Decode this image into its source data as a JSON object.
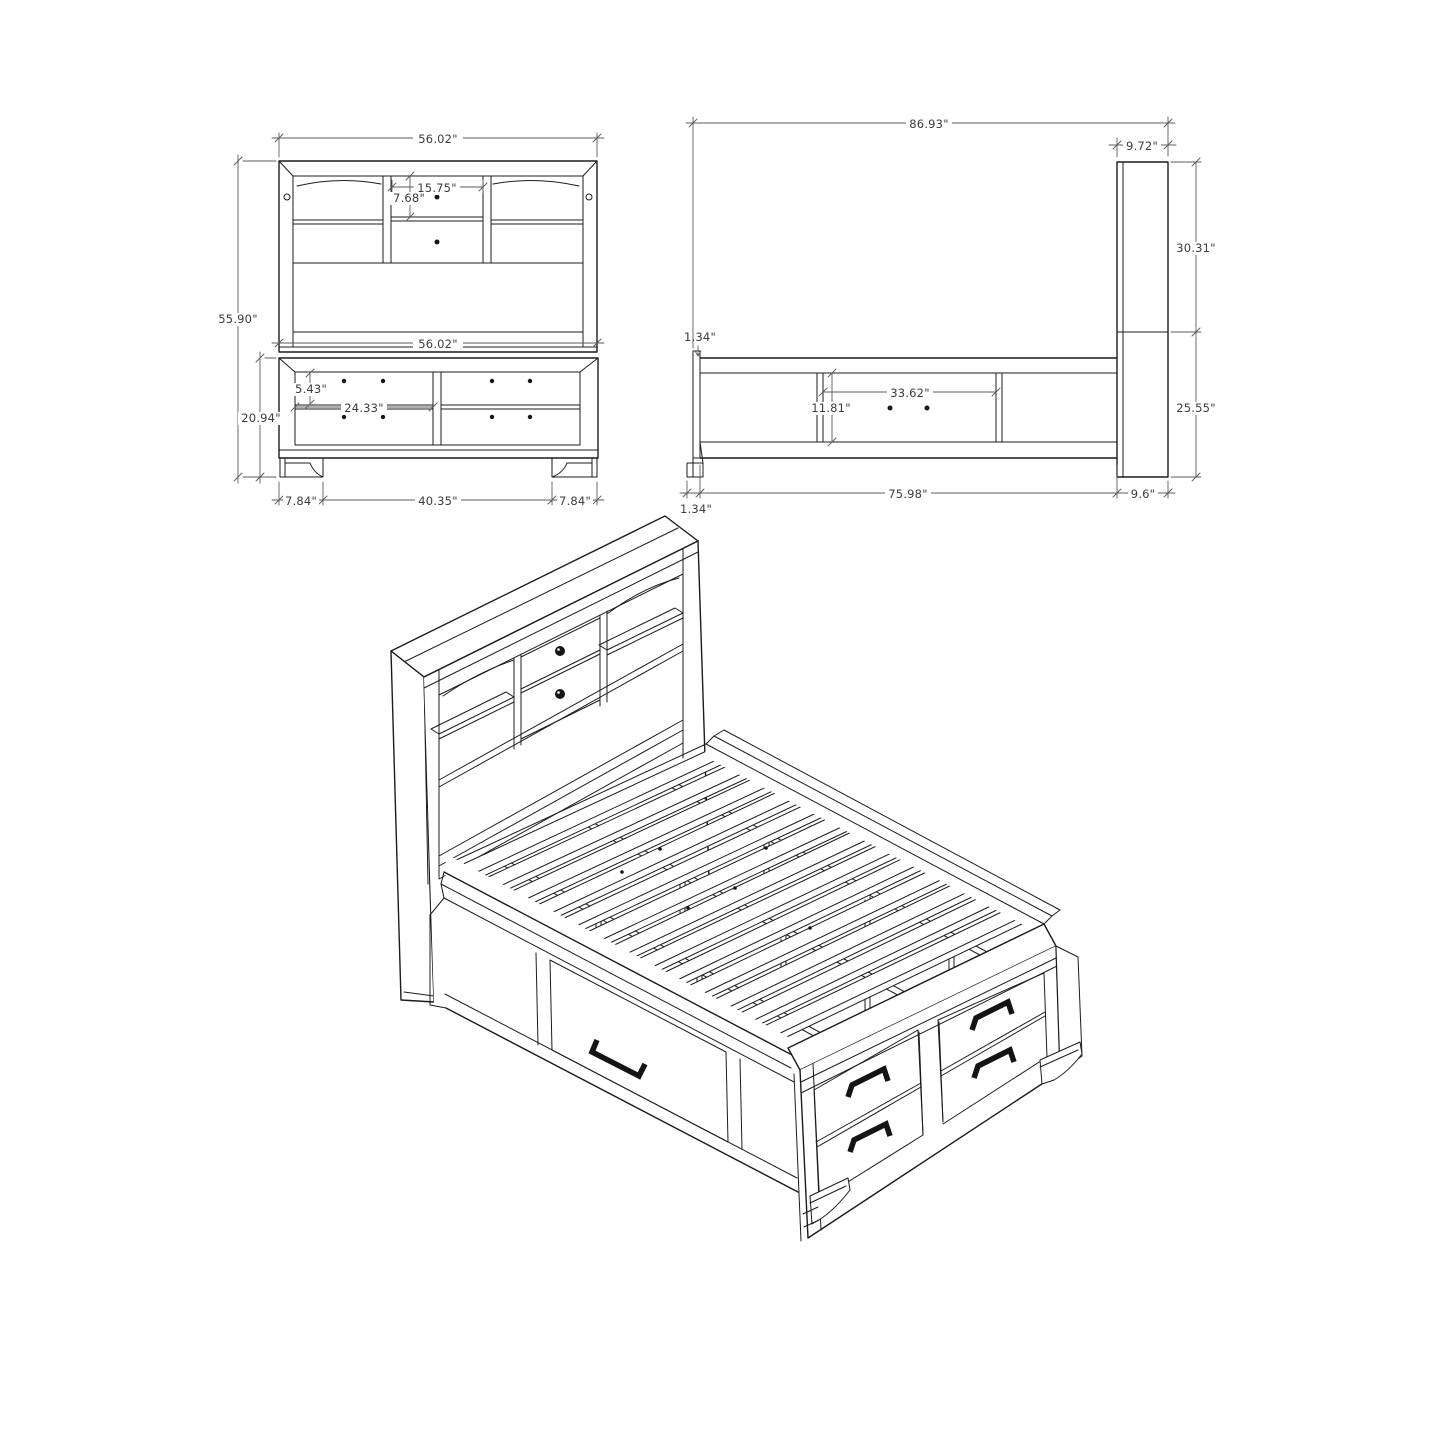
{
  "document": {
    "type": "furniture-dimension-drawing",
    "background": "#ffffff",
    "ink_color": "#1c1c1c",
    "dimension_color": "#5c5c5c"
  },
  "views": {
    "front_elevation": {
      "dims": {
        "headboard_width": "56.02\"",
        "center_opening_width": "15.75\"",
        "center_drawer_height": "7.68\"",
        "overall_height": "55.90\"",
        "footboard_width": "56.02\"",
        "drawer_height": "5.43\"",
        "drawer_width": "24.33\"",
        "footboard_height": "20.94\"",
        "left_foot_width": "7.84\"",
        "foot_spacing": "40.35\"",
        "right_foot_width": "7.84\""
      }
    },
    "side_elevation": {
      "dims": {
        "overall_length": "86.93\"",
        "headboard_depth": "9.72\"",
        "headboard_upper_height": "30.31\"",
        "footboard_lip": "1.34\"",
        "side_drawer_width": "33.62\"",
        "side_drawer_height": "11.81\"",
        "platform_height": "25.55\"",
        "rail_length": "75.98\"",
        "headboard_base_depth": "9.6\"",
        "foot_lip": "1.34\""
      }
    },
    "isometric": {
      "description": "storage bed with bookcase headboard, slat platform, side rail drawer and footboard drawers"
    }
  }
}
